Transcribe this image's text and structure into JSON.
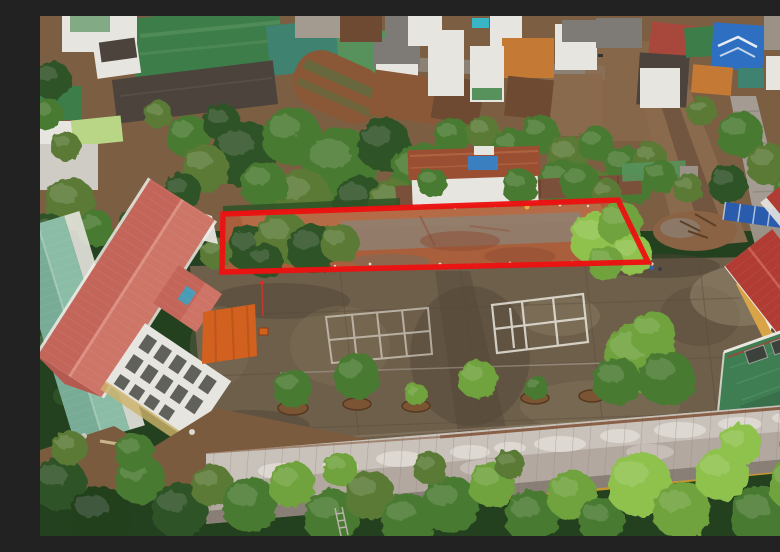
{
  "meta": {
    "title": "Aerial drone photograph",
    "alt": "Aerial drone photo of a school campus beside a residential neighborhood; a long vacant dirt plot between the schoolyard and the houses is highlighted with a thick red quadrilateral outline. The campus shows a long red-roofed school building, an orange canopy, a large weathered concrete yard with faded white court markings, a row of small trees in round planters, a yellow-walled building with a red hip roof, a green flat roof, and an old classroom block with a lichen-covered gray roof bordered by dense trees."
  },
  "annotation": {
    "name": "highlighted-plot-outline",
    "shape": "quadrilateral",
    "color": "#ec1212",
    "stroke_px": 5.5
  },
  "palette": {
    "tree_deep": "#23401f",
    "tree_dark": "#2e5226",
    "tree_mid": "#497a31",
    "tree_olive": "#5a7a35",
    "tree_light": "#6fa23c",
    "tree_bright": "#8fc14e",
    "earth_top": "#7c5f43",
    "road_gray": "#8d857a",
    "road_dirt": "#8a6a4c",
    "plot_base": "#aa5f3c",
    "plot_dark": "#8c4c31",
    "plot_gray": "#8d8276",
    "plot_light": "#c07a4f",
    "red_outline": "#ec1212",
    "yard_base": "#6e5f4b",
    "yard_dark": "#4e4233",
    "yard_light": "#85755c",
    "yard_pale": "#9a8b71",
    "court_line": "#e8e4da",
    "school_roof": "#c4655a",
    "school_roof_light": "#d58472",
    "school_ridge": "#e0998a",
    "bldg_white": "#e7e5df",
    "window_dark": "#4a4a46",
    "teal_roof": "#8bbca6",
    "canopy_orange": "#d2601f",
    "right_roof_red": "#b03c34",
    "right_wall_yellow": "#d9a347",
    "green_roof": "#3e7e52",
    "green_roof_dark": "#2f6242",
    "old_roof": "#b2a8a0",
    "old_roof_light": "#dcd7d0",
    "class_wall_yellow": "#c6952e",
    "roof_green": "#3d7d49",
    "roof_green2": "#57925c",
    "roof_teal2": "#3f8270",
    "roof_dark": "#4c433c",
    "roof_rust": "#8a5836",
    "roof_brown": "#6d4a31",
    "roof_gray": "#7e7a76",
    "roof_blue": "#2f6fc2",
    "roof_red": "#a8473c",
    "roof_orange": "#c47a35",
    "lime_roof": "#b9d687",
    "blue_fence": "#2a5cae",
    "blue_accent": "#38b6c6"
  },
  "scene": {
    "regions": [
      {
        "name": "residential-neighborhood",
        "position": "top"
      },
      {
        "name": "highlighted-vacant-plot",
        "position": "center, outlined in red"
      },
      {
        "name": "school-campus-yard",
        "position": "center-bottom"
      },
      {
        "name": "classroom-building",
        "position": "bottom"
      },
      {
        "name": "tree-canopy",
        "position": "middle and bottom bands"
      }
    ]
  }
}
